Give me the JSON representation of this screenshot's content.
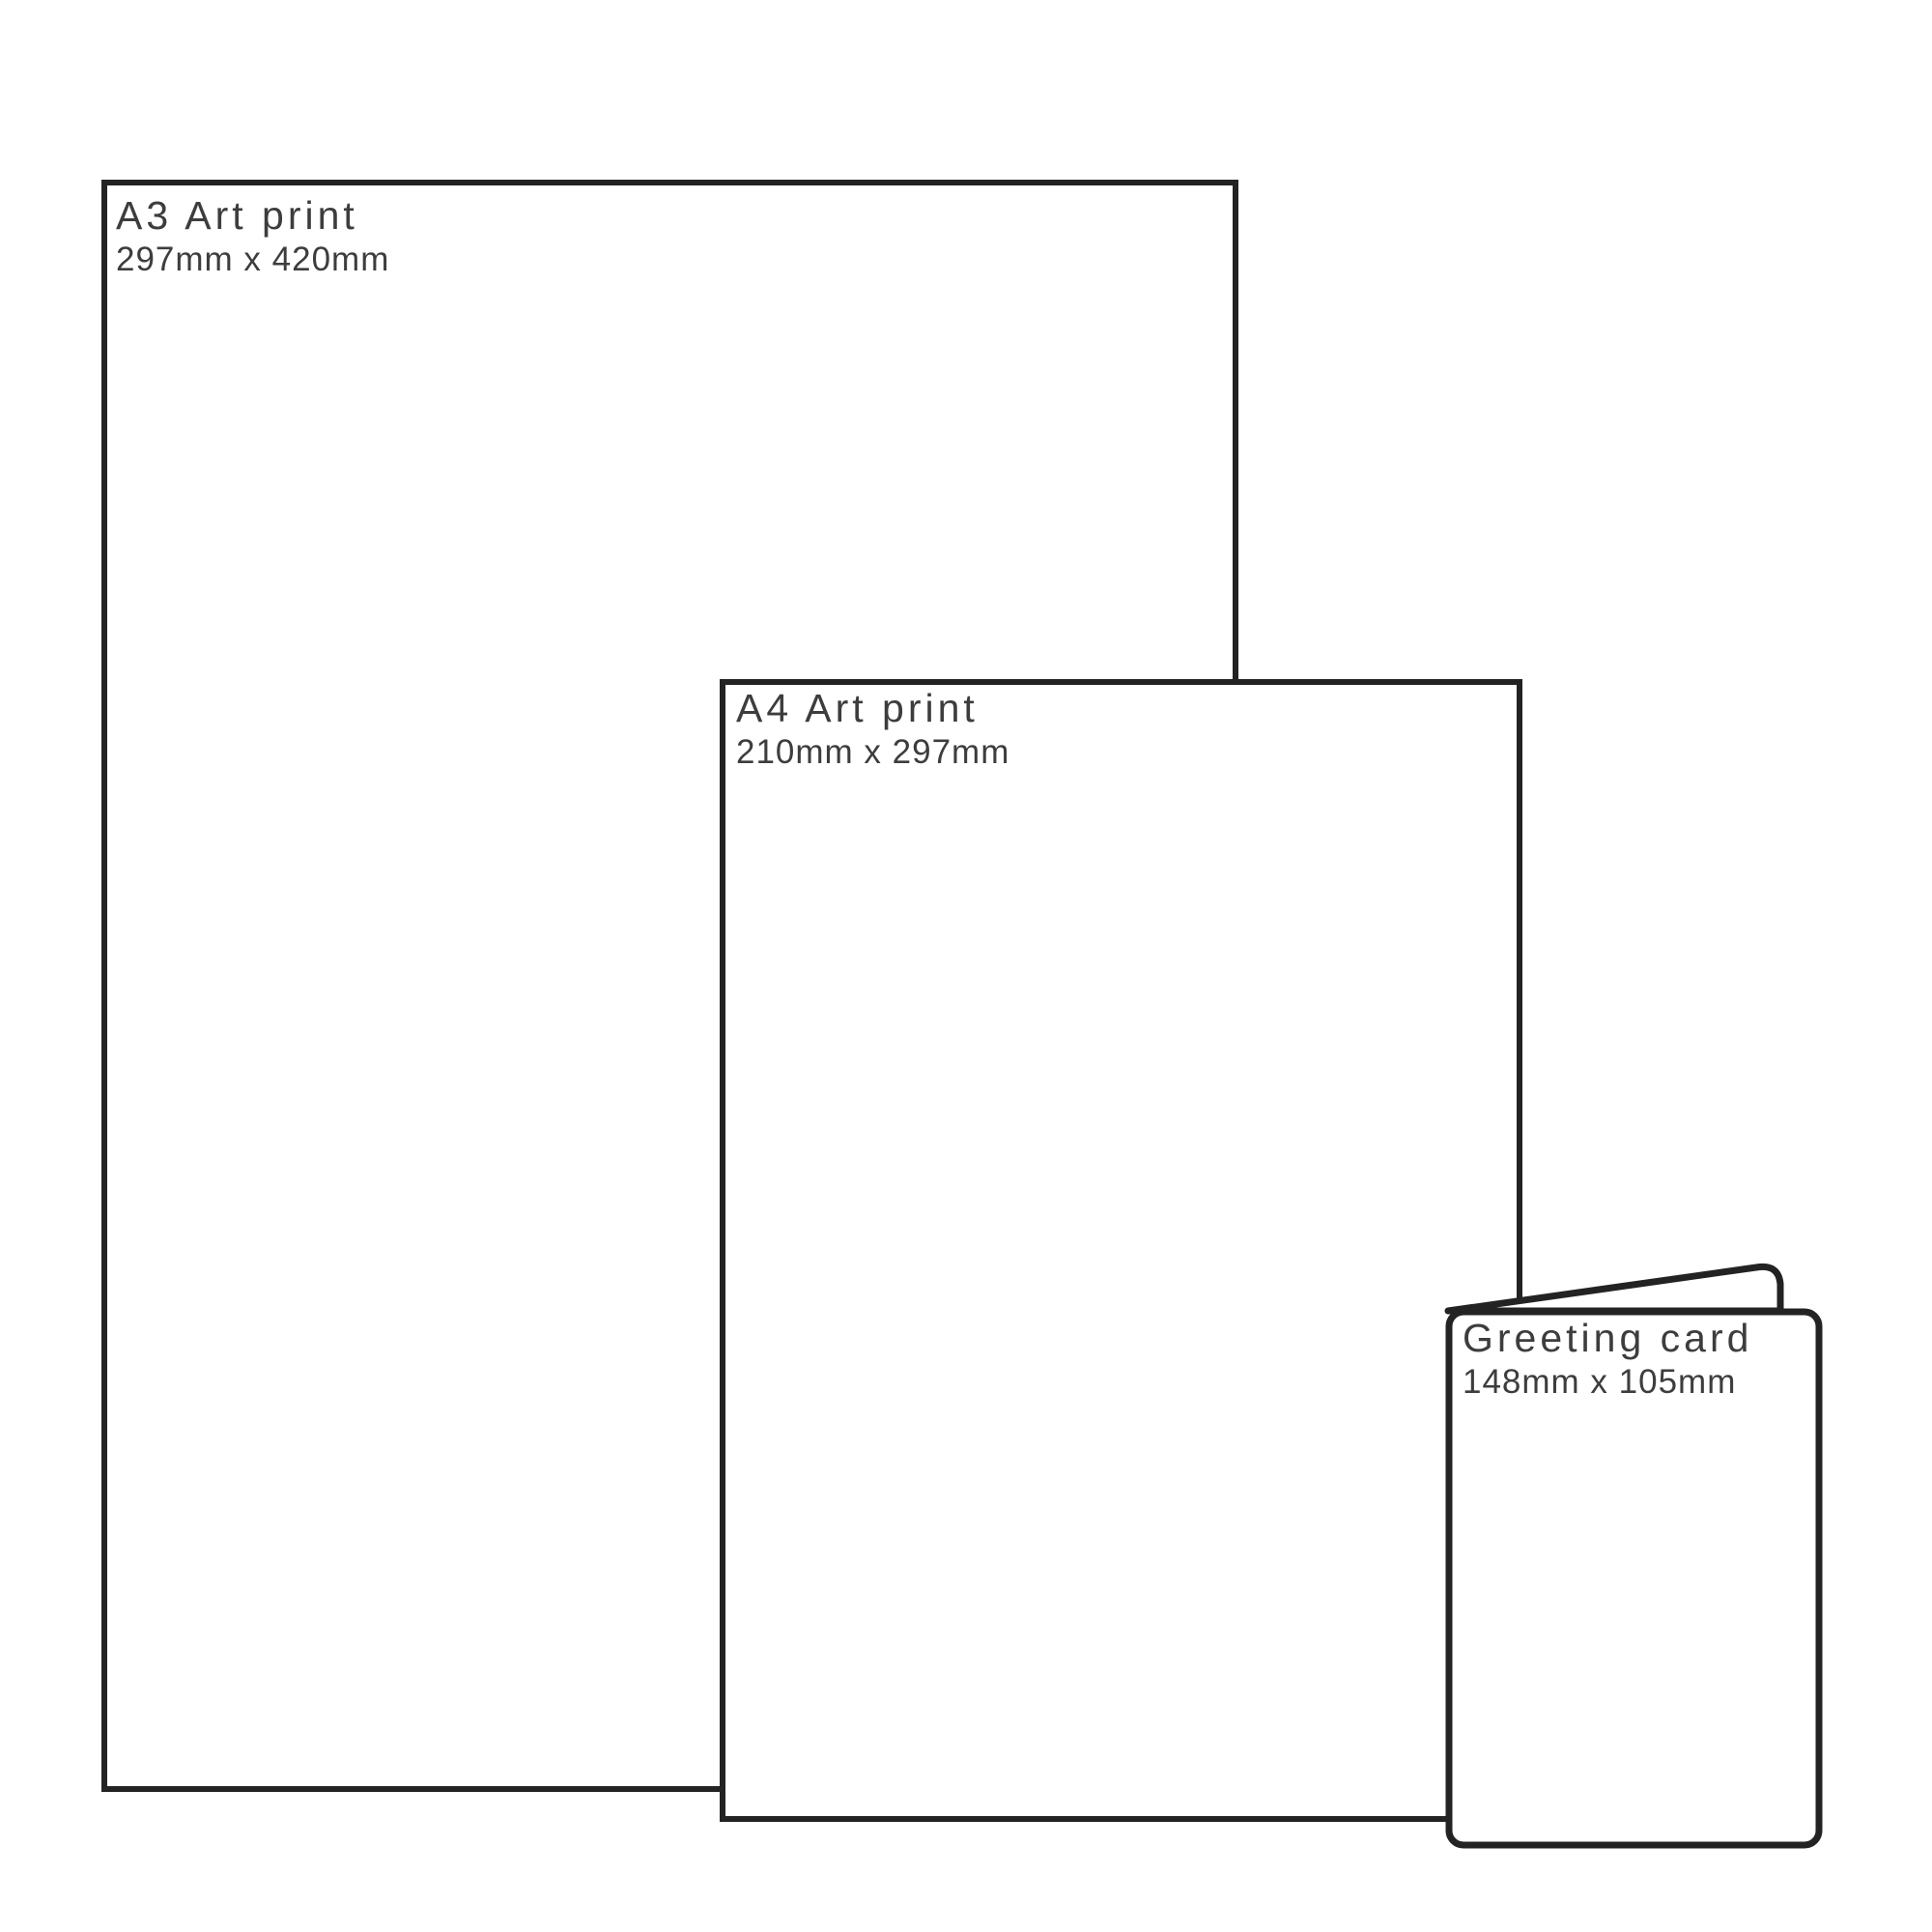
{
  "diagram": {
    "description": "Print size comparison",
    "background_color": "#ffffff",
    "stroke_color": "#232323",
    "text_color": "#3d3d3d",
    "items": [
      {
        "name": "a3-art-print",
        "title": "A3 Art print",
        "size": "297mm x 420mm"
      },
      {
        "name": "a4-art-print",
        "title": "A4 Art print",
        "size": "210mm x 297mm"
      },
      {
        "name": "greeting-card",
        "title": "Greeting card",
        "size": "148mm x 105mm"
      }
    ]
  }
}
